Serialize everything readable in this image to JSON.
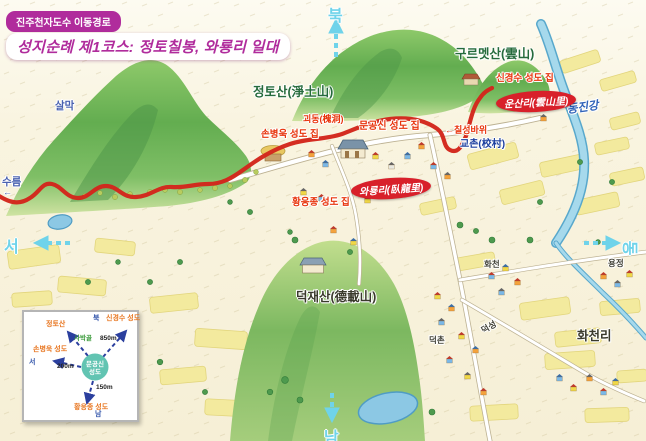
{
  "title": {
    "subtitle": "진주천자도수 이동경로",
    "main": "성지순례 제1코스: 정토칠봉, 와룡리 일대"
  },
  "compass": {
    "north": "북",
    "south": "남",
    "west": "서",
    "east": "동"
  },
  "labels": {
    "salmak": "살막",
    "sureum": "수름",
    "jeongtosan": "정토산(淨土山)",
    "gureumetsan": "구르멧산(雲山)",
    "singyeongsu_house": "신경수 성도 집",
    "unsanri": "운산리(雲山里)",
    "dongjingang": "동진강",
    "goedong": "괴동(槐洞)",
    "mungongsin_house": "문공신 성도 집",
    "sonbyeonguk_house": "손병욱 성도 집",
    "chilseongbawi": "칠성바위",
    "gyochon": "교촌(校村)",
    "waryongri": "와룡리(臥龍里)",
    "hwangeungjong_house": "황응종 성도 집",
    "deokjaesan": "덕재산(德載山)",
    "hwacheon": "화천",
    "yongjeong": "용정",
    "deokseong": "덕성",
    "deokchon": "덕촌",
    "hwacheonri": "화천리"
  },
  "icons": {
    "left_arrow": "←"
  },
  "inset": {
    "north": "북",
    "south": "남",
    "west": "서",
    "center_line1": "문공신",
    "center_line2": "성도",
    "nw_dest": "정토산",
    "nw_via": "사박골",
    "ne_dest": "신경수 성도",
    "ne_dist": "850m",
    "w_dest": "손병욱 성도",
    "w_dist": "200m",
    "s_dest": "황응종 성도",
    "s_dist": "150m"
  },
  "colors": {
    "title_magenta": "#b02c9c",
    "route_red": "#d3261c",
    "badge_red": "#d8202a",
    "compass_cyan": "#6fd3ea",
    "house_label_red": "#e8340c",
    "mountain_label_green": "#266b3c",
    "river_label_blue": "#2f62b8",
    "gyochon_navy": "#1c3f9e",
    "inset_arrow_blue": "#2b3f9e",
    "inset_circle_teal": "#62c4b2",
    "inset_dest_orange": "#e87722"
  }
}
